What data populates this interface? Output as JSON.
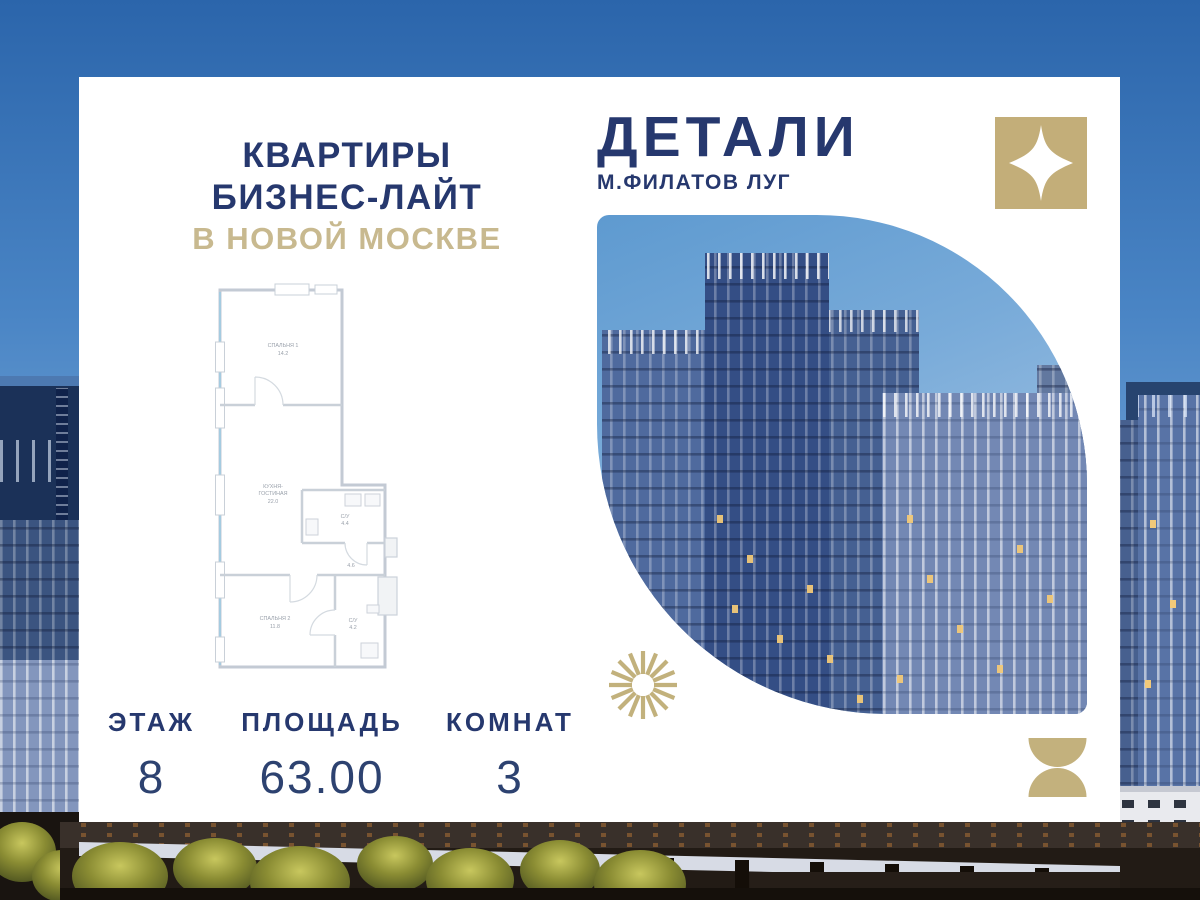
{
  "headline": {
    "line1": "КВАРТИРЫ",
    "line2": "БИЗНЕС-ЛАЙТ",
    "line3": "В НОВОЙ МОСКВЕ"
  },
  "brand": {
    "name": "ДЕТАЛИ",
    "location": "М.ФИЛАТОВ ЛУГ"
  },
  "floorplan": {
    "bedroom1_label": "СПАЛЬНЯ 1",
    "bedroom1_area": "14.2",
    "kitchen_label1": "КУХНЯ-",
    "kitchen_label2": "ГОСТИНАЯ",
    "kitchen_area": "22.0",
    "bath1_label": "С/У",
    "bath1_area": "4.4",
    "hall_area": "4.6",
    "bedroom2_label": "СПАЛЬНЯ 2",
    "bedroom2_area": "11.8",
    "bath2_label": "С/У",
    "bath2_area": "4.2"
  },
  "stats": [
    {
      "label": "ЭТАЖ",
      "value": "8"
    },
    {
      "label": "ПЛОЩАДЬ",
      "value": "63.00"
    },
    {
      "label": "КОМНАТ",
      "value": "3"
    }
  ],
  "icons": {
    "brand_mark": "sparkle-star-icon",
    "decor_top": "sunburst-icon",
    "decor_bottom": "hourglass-icon"
  },
  "colors": {
    "navy": "#26386e",
    "gold": "#c3b07c"
  }
}
